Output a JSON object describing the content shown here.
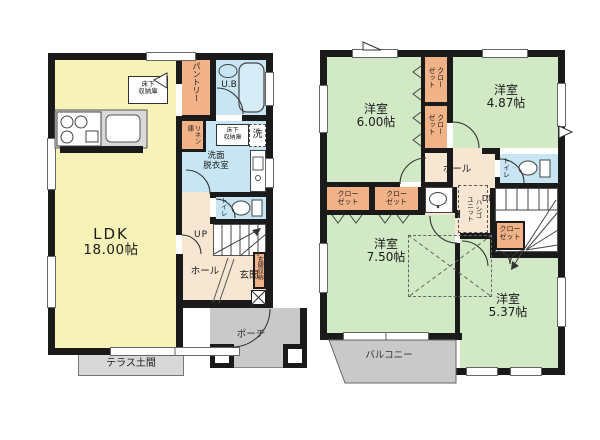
{
  "colors": {
    "wall": "#1a1a1a",
    "ldk_yellow": "#f6f2b8",
    "bedroom_green": "#d2e9c5",
    "wet_blue": "#c8e5f3",
    "storage_orange": "#f1b287",
    "hall_beige": "#f7e6d2",
    "outdoor_gray": "#c9c9c9"
  },
  "floor1": {
    "ldk": {
      "name": "LDK",
      "size": "18.00帖"
    },
    "pantry": "パントリー",
    "unit_bath": "U.B",
    "underfloor_storage": [
      "床下",
      "収納庫"
    ],
    "linen": "リネン庫",
    "laundry": "洗",
    "washroom": [
      "洗面",
      "脱衣室"
    ],
    "toilet": "トイレ",
    "stairs": "UP",
    "hall": "ホール",
    "entrance": "玄関",
    "entrance_storage": "玄関収納",
    "porch": "ポーチ",
    "terrace": "テラス土間"
  },
  "floor2": {
    "room_nw": {
      "name": "洋室",
      "size": "6.00帖"
    },
    "room_ne": {
      "name": "洋室",
      "size": "4.87帖"
    },
    "room_sw": {
      "name": "洋室",
      "size": "7.50帖"
    },
    "room_se": {
      "name": "洋室",
      "size": "5.37帖"
    },
    "closet": "クローゼット",
    "closet_two_line": [
      "クロー",
      "ゼット"
    ],
    "hall": "ホール",
    "toilet": "トイレ",
    "stairs": "DN",
    "ladder_unit": [
      "ハシゴ",
      "ユニット"
    ],
    "balcony": "バルコニー"
  }
}
